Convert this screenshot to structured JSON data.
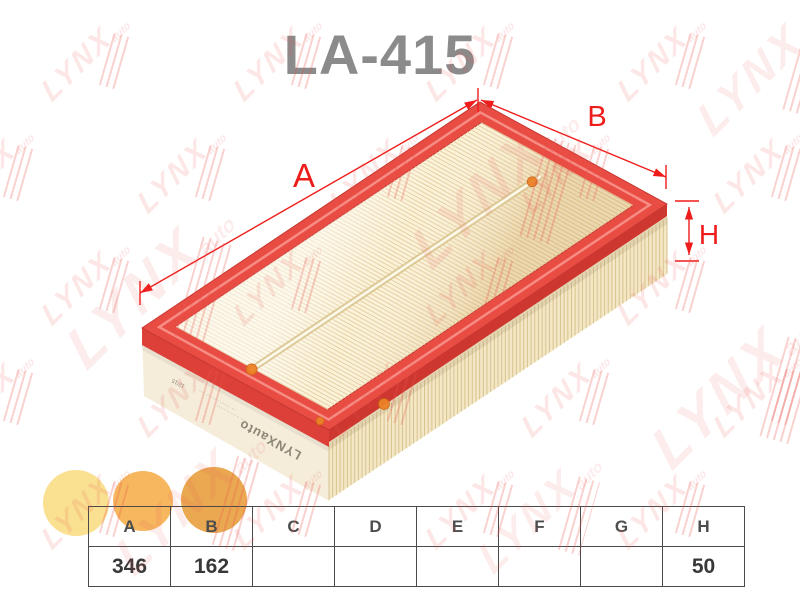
{
  "title": "LA-415",
  "annotations": {
    "a": "A",
    "b": "B",
    "h": "H"
  },
  "table": {
    "headers": [
      "A",
      "B",
      "C",
      "D",
      "E",
      "F",
      "G",
      "H"
    ],
    "values": [
      "346",
      "162",
      "",
      "",
      "",
      "",
      "",
      "50"
    ]
  },
  "filter_markings": {
    "side_logo": "LYNXauto",
    "date_stamp": "12/15",
    "micro_text_1": "··· ······· ········· ····",
    "micro_text_2": "···· ········· ······"
  },
  "watermark": {
    "text": "LYNX",
    "suffix": "auto"
  },
  "swatches": [
    "#FAE091",
    "#F6B75F",
    "#EAA851"
  ],
  "colors": {
    "dim_red": "#EE1D1B",
    "frame_red": "#E94C43",
    "frame_dark": "#C63831",
    "frame_highlight": "#F7938B",
    "lip_left": "#DC4038",
    "lip_right": "#CE372F",
    "pleat_bg": "#FBF2D9",
    "pleat_line": "#E4CFA0",
    "wall_cream": "#F5EDDA",
    "wall_pleat_bg": "#F3E7C6",
    "wall_pleat_line": "#D9C38D",
    "seam_mid": "#D8C48E",
    "seam_light": "#F7EFD3",
    "glue_dot": "#EC8226",
    "title_gray": "#8B8B8B",
    "table_border": "#4A4A4A"
  }
}
